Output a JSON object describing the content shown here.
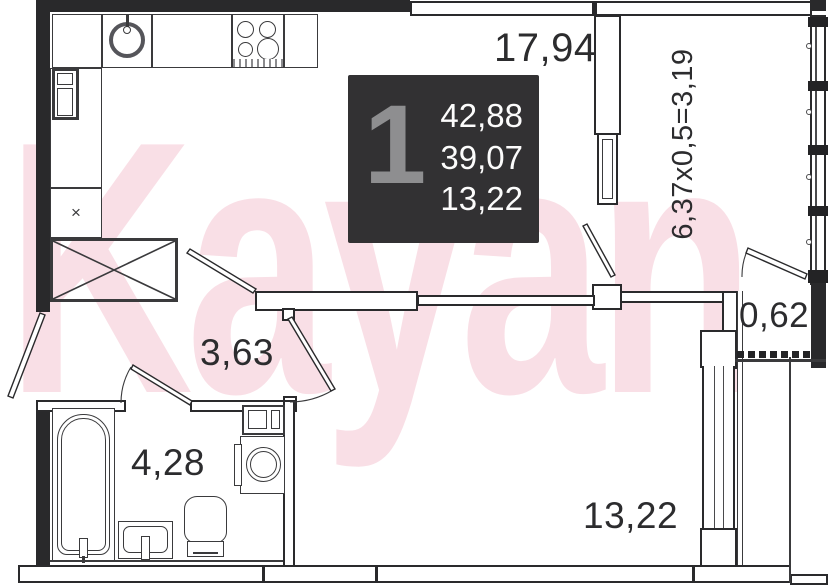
{
  "watermark": "Kayan",
  "info_box": {
    "unit_number": "1",
    "area_total": "42,88",
    "area_living": "39,07",
    "area_room": "13,22"
  },
  "rooms": {
    "kitchen_living_area": "17,94",
    "hallway_area": "3,63",
    "bathroom_area": "4,28",
    "room_area": "13,22",
    "balcony_pocket_area": "0,62",
    "balcony_calculation": "6,37x0,5=3,19"
  },
  "symbols": {
    "ventilation": "×"
  },
  "colors": {
    "wall": "#29292b",
    "info_box_bg": "#323133",
    "info_box_number": "#8e8e90",
    "info_box_text": "#fcfcfc",
    "watermark": "#f5c6d2",
    "label": "#2c2c2e"
  }
}
